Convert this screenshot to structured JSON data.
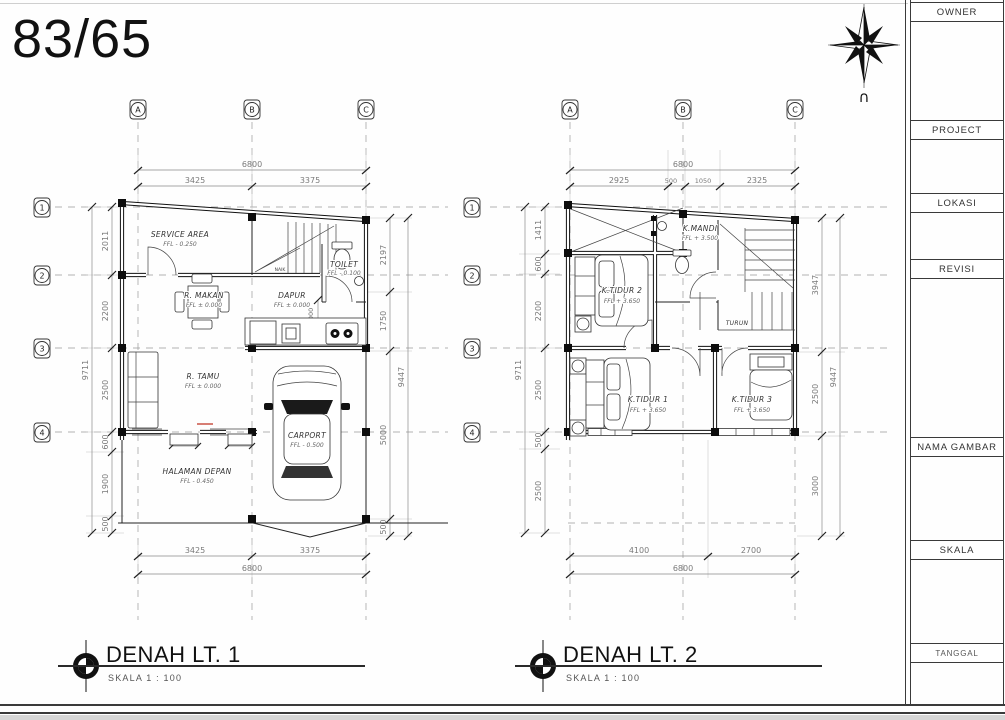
{
  "page": {
    "sheet_title": "83/65",
    "north_label": "∩"
  },
  "titleblock": {
    "sections": [
      {
        "label": "OWNER"
      },
      {
        "label": "PROJECT"
      },
      {
        "label": "LOKASI"
      },
      {
        "label": "REVISI"
      },
      {
        "label": "NAMA GAMBAR"
      },
      {
        "label": "SKALA"
      },
      {
        "label": "TANGGAL"
      }
    ]
  },
  "plan1": {
    "title": "DENAH LT. 1",
    "scale": "SKALA 1 : 100",
    "grid_cols": [
      "A",
      "B",
      "C"
    ],
    "grid_rows": [
      "1",
      "2",
      "3",
      "4"
    ],
    "dim_total": "6800",
    "dims_top": [
      "3425",
      "3375"
    ],
    "dims_bottom": [
      "3425",
      "3375"
    ],
    "dim_total_bottom": "6800",
    "dims_left": [
      "2011",
      "2200",
      "2500",
      "600",
      "1900",
      "500"
    ],
    "dim_left_total": "9711",
    "dims_right": [
      "2197",
      "1750",
      "5000",
      "500"
    ],
    "dim_right_total": "9447",
    "dims_inner": [
      "1000",
      "700",
      "650"
    ],
    "stair_label": "NAIK",
    "rooms": [
      {
        "name": "SERVICE AREA",
        "ffl": "FFL - 0.250"
      },
      {
        "name": "TOILET",
        "ffl": "FFL - 0.100"
      },
      {
        "name": "R. MAKAN",
        "ffl": "FFL ± 0.000"
      },
      {
        "name": "DAPUR",
        "ffl": "FFL ± 0.000"
      },
      {
        "name": "R. TAMU",
        "ffl": "FFL ± 0.000"
      },
      {
        "name": "CARPORT",
        "ffl": "FFL - 0.500"
      },
      {
        "name": "HALAMAN DEPAN",
        "ffl": "FFL - 0.450"
      }
    ]
  },
  "plan2": {
    "title": "DENAH LT. 2",
    "scale": "SKALA 1 : 100",
    "grid_cols": [
      "A",
      "B",
      "C"
    ],
    "grid_rows": [
      "1",
      "2",
      "3",
      "4"
    ],
    "dim_total": "6800",
    "dims_top": [
      "2925",
      "500",
      "1050",
      "2325"
    ],
    "dims_bottom": [
      "4100",
      "2700"
    ],
    "dim_total_bottom": "6800",
    "dims_left": [
      "1411",
      "600",
      "2200",
      "2500",
      "500",
      "2500"
    ],
    "dim_left_total": "9711",
    "dims_right": [
      "3947",
      "2500",
      "3000"
    ],
    "dim_right_total": "9447",
    "rooms": [
      {
        "name": "K.MANDI",
        "ffl": "FFL + 3.500"
      },
      {
        "name": "K.TIDUR 2",
        "ffl": "FFL + 3.650"
      },
      {
        "name": "TURUN",
        "ffl": ""
      },
      {
        "name": "K.TIDUR 1",
        "ffl": "FFL + 3.650"
      },
      {
        "name": "K.TIDUR 3",
        "ffl": "FFL + 3.650"
      }
    ]
  }
}
